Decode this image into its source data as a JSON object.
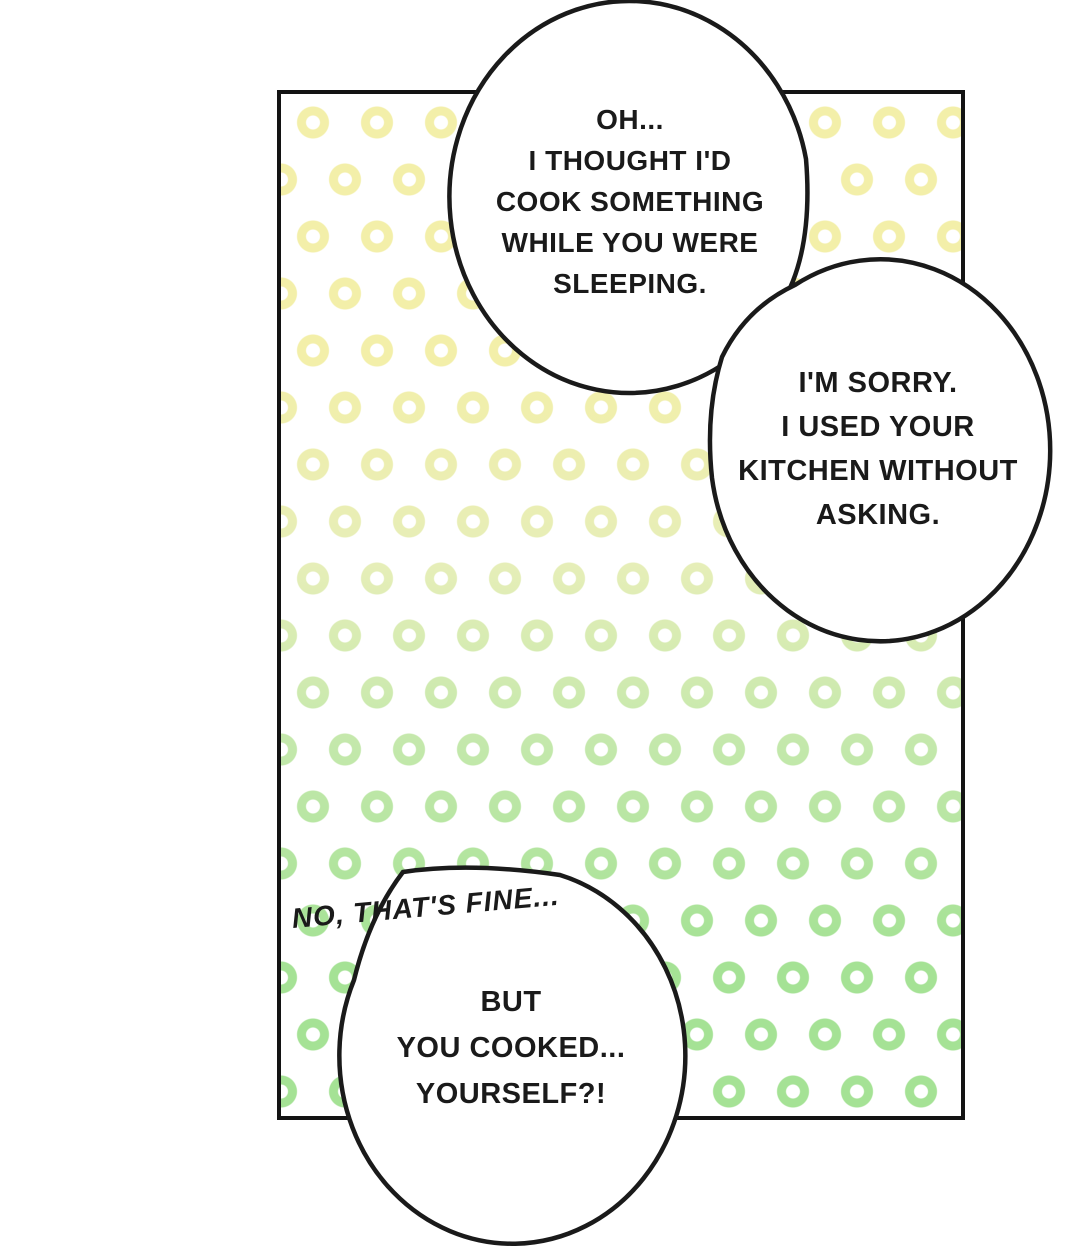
{
  "page": {
    "type": "comic-panel-page"
  },
  "colors": {
    "page-bg": "#ffffff",
    "ink": "#1a1a1a",
    "panel-border": "#131313",
    "bubble-fill": "#ffffff",
    "ring-yellow": "#f3efa9",
    "ring-yellowgreen": "#e6eeb8",
    "ring-lightgreen": "#c3e8ab",
    "ring-green": "#a5e295"
  },
  "dialogue": {
    "bubble1": {
      "lines": [
        "OH...",
        "I THOUGHT I'D",
        "COOK SOMETHING",
        "WHILE YOU WERE",
        "SLEEPING."
      ]
    },
    "bubble2": {
      "lines": [
        "I'M SORRY.",
        "I USED YOUR",
        "KITCHEN WITHOUT",
        "ASKING."
      ]
    },
    "offpanel": {
      "text": "NO, THAT'S FINE..."
    },
    "bubble3": {
      "lines": [
        "BUT",
        "YOU COOKED...",
        "YOURSELF?!"
      ]
    }
  }
}
